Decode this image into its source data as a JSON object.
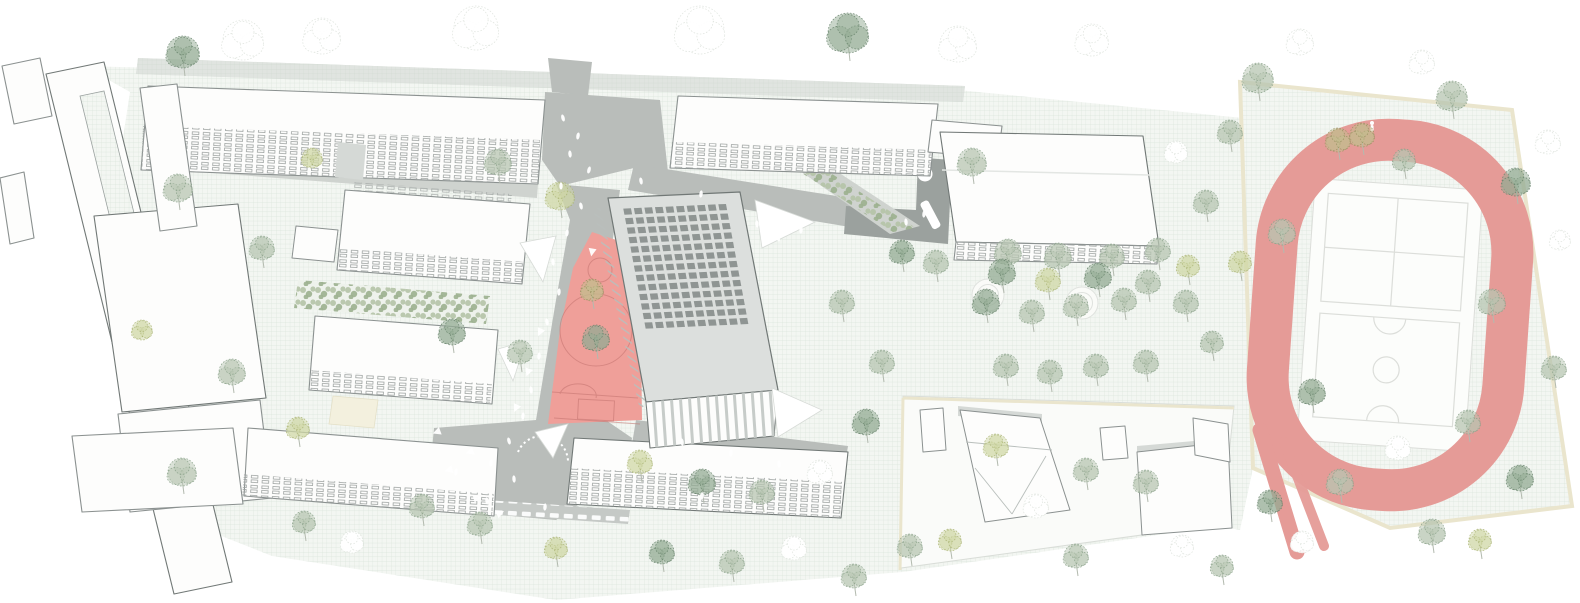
{
  "scene_names": {
    "tree": "tree",
    "person": "person-figure",
    "arrow": "direction-arrow-marking",
    "panel": "roof-solar-panel",
    "canopy": "shade-canopy",
    "ripple": "gravel-circle"
  },
  "palette": {
    "mintBg": "#f3f6f2",
    "mintLine": "#d9e4da",
    "road": "#c9cfc9",
    "plaza": "#b9bdba",
    "walk": "#cfd3cf",
    "deck": "#9ba19e",
    "band": "#c5c9c6",
    "roofWhite": "#fdfdfc",
    "sideFace": "#e9ece9",
    "outline": "#8b9190",
    "outlineDark": "#717876",
    "mainRoof": "#dcdfdd",
    "panel": "#8f9593",
    "arcadeStripe": "#c7ccc9",
    "tickLine": "#b9bfbc",
    "winLine": "#9aa09e",
    "courtPink": "#ef9f99",
    "courtLine": "#c3736f",
    "trackPink": "#e59b97",
    "infield": "#fcfdfb",
    "infieldLine": "#dcdeda",
    "cream": "#eae5cd",
    "sand": "#f3f0de",
    "residential": "#fafbf9",
    "residentialLine": "#d9ddd8",
    "accentGray": "#d5d9d6",
    "bushA": "#b5c4a8",
    "bushB": "#9db18f",
    "stemColor": "#b3baaf",
    "figureWhite": "#ffffff"
  },
  "tree_colors": {
    "sage": {
      "fill": "#b8c6b2",
      "stroke": "#87a087"
    },
    "dark": {
      "fill": "#93ab94",
      "stroke": "#647f68"
    },
    "lime": {
      "fill": "#d0d8a6",
      "stroke": "#a8b272"
    },
    "olive": {
      "fill": "#c2bd8d",
      "stroke": "#968f5e"
    },
    "ghost": {
      "fill": "#ffffff",
      "stroke": "#dbe1da"
    }
  },
  "trees": [
    [
      183,
      52,
      16,
      "dark"
    ],
    [
      243,
      40,
      20,
      "ghost"
    ],
    [
      322,
      36,
      18,
      "ghost"
    ],
    [
      476,
      28,
      22,
      "ghost"
    ],
    [
      700,
      30,
      24,
      "ghost"
    ],
    [
      848,
      33,
      20,
      "dark"
    ],
    [
      958,
      44,
      18,
      "ghost"
    ],
    [
      1092,
      40,
      16,
      "ghost"
    ],
    [
      1258,
      78,
      15,
      "sage"
    ],
    [
      1300,
      42,
      13,
      "ghost"
    ],
    [
      1362,
      135,
      12,
      "olive"
    ],
    [
      1422,
      62,
      12,
      "ghost"
    ],
    [
      1452,
      96,
      15,
      "sage"
    ],
    [
      1516,
      182,
      14,
      "dark"
    ],
    [
      1548,
      142,
      12,
      "ghost"
    ],
    [
      1338,
      140,
      12,
      "olive"
    ],
    [
      1404,
      160,
      11,
      "sage"
    ],
    [
      1282,
      232,
      13,
      "sage"
    ],
    [
      1312,
      392,
      13,
      "dark"
    ],
    [
      1340,
      482,
      13,
      "sage"
    ],
    [
      1398,
      448,
      12,
      "ghost"
    ],
    [
      1432,
      532,
      13,
      "sage"
    ],
    [
      1468,
      422,
      12,
      "sage"
    ],
    [
      1492,
      302,
      13,
      "sage"
    ],
    [
      1520,
      478,
      13,
      "dark"
    ],
    [
      1554,
      368,
      12,
      "sage"
    ],
    [
      1302,
      542,
      11,
      "ghost"
    ],
    [
      1270,
      502,
      12,
      "dark"
    ],
    [
      1480,
      540,
      11,
      "lime"
    ],
    [
      1560,
      240,
      10,
      "ghost"
    ],
    [
      972,
      162,
      14,
      "sage"
    ],
    [
      1008,
      252,
      13,
      "sage"
    ],
    [
      1058,
      256,
      13,
      "sage"
    ],
    [
      1112,
      256,
      12,
      "sage"
    ],
    [
      1158,
      250,
      12,
      "sage"
    ],
    [
      986,
      302,
      13,
      "dark"
    ],
    [
      1032,
      312,
      12,
      "sage"
    ],
    [
      1076,
      306,
      12,
      "sage"
    ],
    [
      1124,
      300,
      12,
      "sage"
    ],
    [
      1006,
      366,
      12,
      "sage"
    ],
    [
      1050,
      372,
      12,
      "sage"
    ],
    [
      1096,
      366,
      12,
      "sage"
    ],
    [
      1146,
      362,
      12,
      "sage"
    ],
    [
      1186,
      302,
      12,
      "sage"
    ],
    [
      1206,
      202,
      12,
      "sage"
    ],
    [
      1230,
      132,
      12,
      "sage"
    ],
    [
      1176,
      152,
      11,
      "ghost"
    ],
    [
      1212,
      342,
      11,
      "sage"
    ],
    [
      1240,
      262,
      11,
      "lime"
    ],
    [
      996,
      446,
      12,
      "lime"
    ],
    [
      1086,
      470,
      12,
      "sage"
    ],
    [
      1036,
      506,
      12,
      "ghost"
    ],
    [
      1146,
      482,
      12,
      "sage"
    ],
    [
      1076,
      556,
      12,
      "sage"
    ],
    [
      1182,
      546,
      11,
      "ghost"
    ],
    [
      1222,
      566,
      11,
      "sage"
    ],
    [
      950,
      540,
      11,
      "lime"
    ],
    [
      498,
      162,
      13,
      "sage"
    ],
    [
      560,
      196,
      14,
      "lime"
    ],
    [
      592,
      290,
      11,
      "olive"
    ],
    [
      596,
      338,
      13,
      "dark"
    ],
    [
      520,
      352,
      12,
      "sage"
    ],
    [
      452,
      332,
      13,
      "dark"
    ],
    [
      640,
      462,
      12,
      "lime"
    ],
    [
      702,
      482,
      13,
      "dark"
    ],
    [
      762,
      492,
      12,
      "sage"
    ],
    [
      820,
      472,
      12,
      "ghost"
    ],
    [
      866,
      422,
      13,
      "dark"
    ],
    [
      882,
      362,
      12,
      "sage"
    ],
    [
      842,
      302,
      12,
      "sage"
    ],
    [
      902,
      252,
      12,
      "dark"
    ],
    [
      936,
      262,
      12,
      "sage"
    ],
    [
      662,
      552,
      12,
      "dark"
    ],
    [
      732,
      562,
      12,
      "sage"
    ],
    [
      794,
      548,
      12,
      "ghost"
    ],
    [
      854,
      576,
      12,
      "sage"
    ],
    [
      910,
      546,
      12,
      "sage"
    ],
    [
      480,
      524,
      12,
      "sage"
    ],
    [
      422,
      506,
      12,
      "sage"
    ],
    [
      352,
      542,
      11,
      "ghost"
    ],
    [
      304,
      522,
      11,
      "sage"
    ],
    [
      556,
      548,
      11,
      "lime"
    ],
    [
      178,
      188,
      14,
      "sage"
    ],
    [
      262,
      248,
      12,
      "sage"
    ],
    [
      232,
      372,
      13,
      "sage"
    ],
    [
      182,
      472,
      14,
      "sage"
    ],
    [
      298,
      428,
      11,
      "lime"
    ],
    [
      142,
      330,
      10,
      "lime"
    ],
    [
      312,
      158,
      10,
      "lime"
    ],
    [
      1002,
      272,
      13,
      "dark"
    ],
    [
      1048,
      280,
      12,
      "lime"
    ],
    [
      1098,
      276,
      13,
      "dark"
    ],
    [
      1148,
      282,
      12,
      "sage"
    ],
    [
      1188,
      266,
      11,
      "lime"
    ]
  ],
  "people": [
    [
      563,
      118,
      -15
    ],
    [
      578,
      136,
      10
    ],
    [
      570,
      154,
      -5
    ],
    [
      589,
      170,
      15
    ],
    [
      561,
      186,
      0
    ],
    [
      581,
      206,
      -12
    ],
    [
      567,
      233,
      8
    ],
    [
      553,
      262,
      -6
    ],
    [
      559,
      292,
      4
    ],
    [
      547,
      322,
      -10
    ],
    [
      539,
      356,
      6
    ],
    [
      531,
      390,
      -8
    ],
    [
      523,
      416,
      5
    ],
    [
      509,
      441,
      -14
    ],
    [
      491,
      463,
      8
    ],
    [
      514,
      479,
      -4
    ],
    [
      456,
      472,
      10
    ],
    [
      487,
      501,
      -8
    ],
    [
      545,
      507,
      5
    ],
    [
      641,
      181,
      -10
    ],
    [
      701,
      194,
      8
    ],
    [
      757,
      224,
      -6
    ],
    [
      801,
      230,
      4
    ],
    [
      682,
      442,
      -8
    ],
    [
      731,
      453,
      6
    ],
    [
      779,
      464,
      -5
    ],
    [
      702,
      496,
      8
    ],
    [
      906,
      222,
      -5
    ],
    [
      924,
      214,
      6
    ],
    [
      768,
      228,
      20
    ],
    [
      778,
      238,
      -20
    ]
  ],
  "arrows": [
    [
      540,
      332,
      205
    ],
    [
      528,
      372,
      200
    ],
    [
      516,
      408,
      205
    ],
    [
      470,
      452,
      250
    ],
    [
      449,
      470,
      255
    ],
    [
      477,
      498,
      75
    ],
    [
      500,
      513,
      65
    ],
    [
      437,
      432,
      250
    ],
    [
      592,
      252,
      190
    ]
  ],
  "canopies": [
    [
      520,
      243,
      556,
      236,
      543,
      282
    ],
    [
      498,
      349,
      526,
      341,
      513,
      381
    ],
    [
      535,
      432,
      568,
      424,
      553,
      458
    ],
    [
      755,
      200,
      815,
      222,
      762,
      248
    ],
    [
      772,
      388,
      822,
      410,
      778,
      437
    ]
  ],
  "solar_panels": {
    "matrix": [
      132,
      -6,
      38,
      204,
      608,
      198
    ],
    "cols": 10,
    "rows": 13,
    "u0": 0.1,
    "u1": 0.9,
    "v0": 0.055,
    "v1": 0.66,
    "pw": 0.058,
    "ph": 0.03
  },
  "ripples": [
    [
      988,
      295
    ],
    [
      1082,
      303
    ]
  ],
  "runner": {
    "x": 1372,
    "y": 127
  }
}
